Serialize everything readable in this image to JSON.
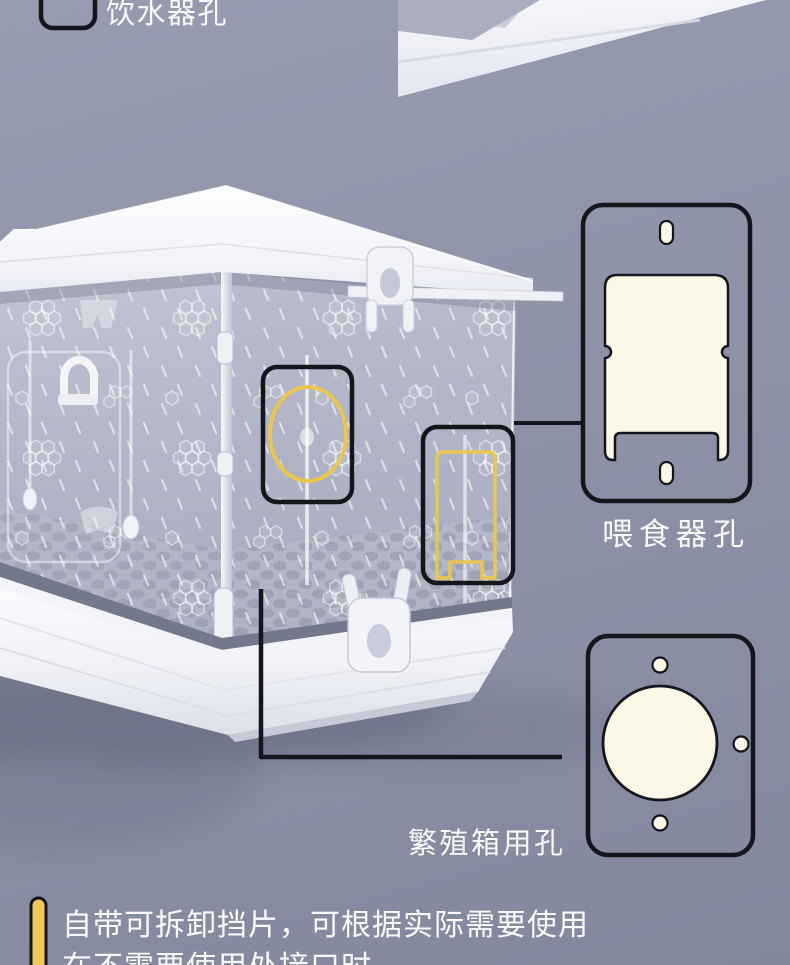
{
  "page": {
    "background_top": "#989CB1",
    "background_bottom": "#83879C",
    "text_color": "#FAFAFC",
    "outline_color": "#15151C"
  },
  "legend": {
    "label": "饮水器孔"
  },
  "product": {
    "description": "transparent-pet-cage-render",
    "highlight_color": "#E8C64F"
  },
  "callouts": {
    "feeder": {
      "label": "喂食器孔",
      "diagram_fill": "#FCF8E8"
    },
    "breeding": {
      "label": "繁殖箱用孔",
      "diagram_fill": "#FCF8E8"
    }
  },
  "note": {
    "line1": "自带可拆卸挡片，可根据实际需要使用",
    "line2": "在不需要使用处接口时",
    "accent_color": "#EFC95C"
  }
}
